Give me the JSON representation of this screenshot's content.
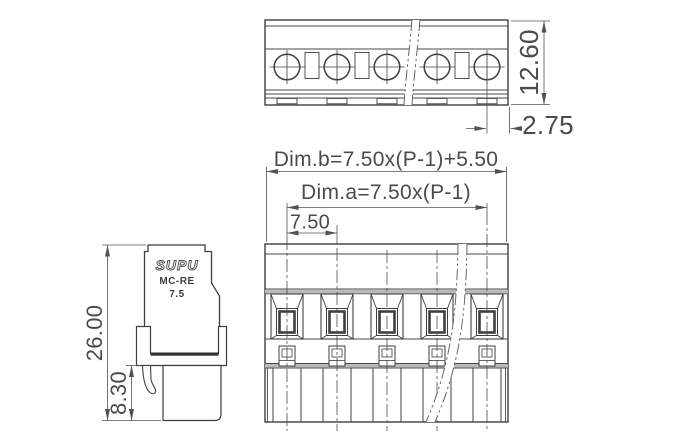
{
  "dimensions": {
    "top_view_height": "12.60",
    "screw_to_edge": "2.75",
    "overall_width_formula": "Dim.b=7.50x(P-1)+5.50",
    "span_formula": "Dim.a=7.50x(P-1)",
    "pitch": "7.50",
    "total_height": "26.00",
    "pin_section_height": "8.30"
  },
  "logo": {
    "brand": "SUPU",
    "series": "MC-RE",
    "pitch_label": "7.5"
  },
  "structure": {
    "poles_visible": 5,
    "views": [
      "top",
      "side",
      "front"
    ]
  },
  "colors": {
    "outline": "#3f3f3f",
    "thin_line": "#4a4a4a",
    "dimension": "#525252",
    "band": "#b9b9b9",
    "background": "#ffffff"
  }
}
